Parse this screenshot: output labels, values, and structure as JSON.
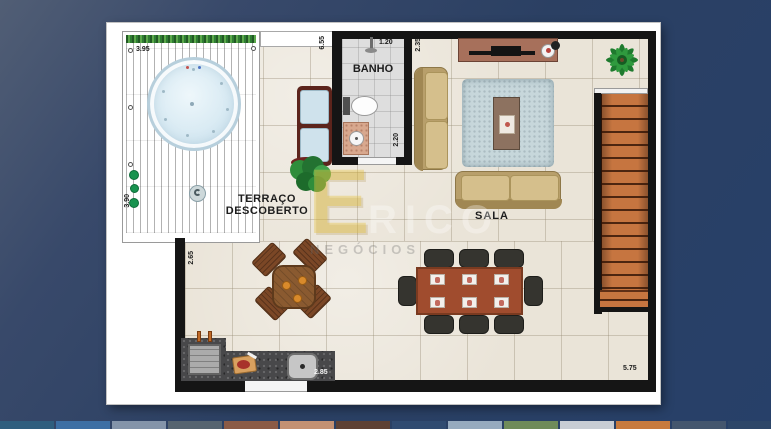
{
  "gallery": {
    "thumbnails": [
      "#2f5e7e",
      "#3d6fa4",
      "#8494a9",
      "#566470",
      "#8b5b46",
      "#c39173",
      "#5e4134",
      "#304b71",
      "#96aabe",
      "#6f8b5a",
      "#c8cdd4",
      "#c77a3e",
      "#44566e",
      "#2d4668"
    ]
  },
  "floorplan": {
    "rooms": {
      "bathroom": "BANHO",
      "terrace_line1": "TERRAÇO",
      "terrace_line2": "DESCOBERTO",
      "living_room": "SALA"
    },
    "dimensions": {
      "deck_top": "3.95",
      "deck_left": "3.90",
      "terrace_wall": "6.55",
      "bath_top": "1.20",
      "bath_side": "2.20",
      "living_top_wall": "2.35",
      "terrace_left_wall": "2.65",
      "barbecue_counter": "2.85",
      "living_bottom": "5.75"
    },
    "colors": {
      "background_navy": "#2c4166",
      "wall": "#151515",
      "floor_tile": "#eae4d8",
      "deck_wood": "#6b3c30",
      "hedge_green": "#2f7d33",
      "spa_water": "#d8e9f2",
      "sofa_beige": "#c8b07a",
      "stairs_orange": "#c67540",
      "counter_granite": "#48484a",
      "dining_wood": "#a04c2e"
    }
  },
  "watermark": {
    "logo_letter": "E",
    "brand": "RICO",
    "tagline": "NEGÓCIOS"
  }
}
